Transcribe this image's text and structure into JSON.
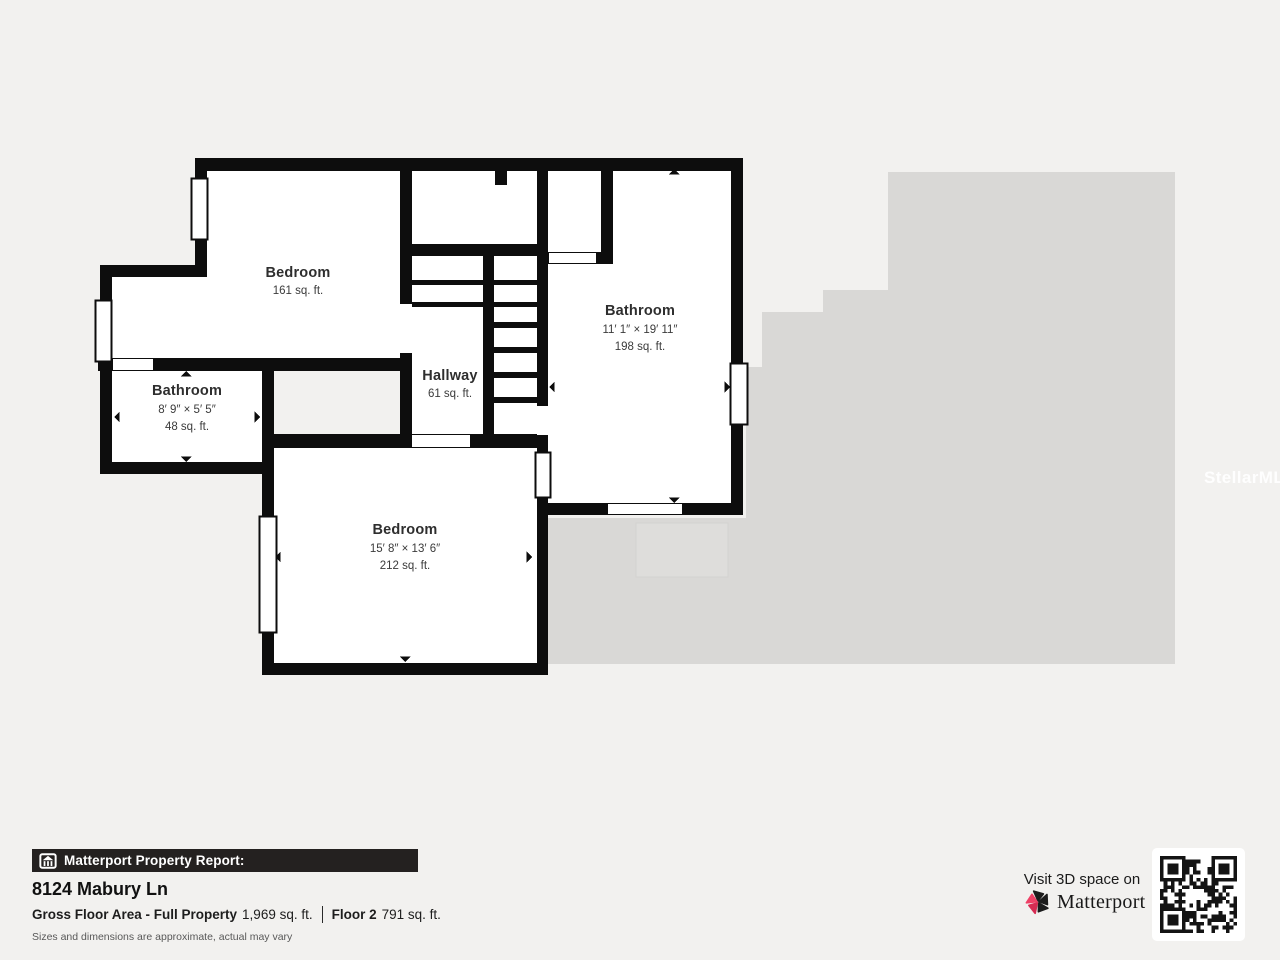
{
  "colors": {
    "background": "#f2f1ef",
    "silhouette_gray": "#d9d8d6",
    "wall_black": "#0d0d0d",
    "accent_pink": "#e93c5f",
    "report_bar_bg": "#242120"
  },
  "floor_plan": {
    "watermark": "StellarMLS",
    "rooms": [
      {
        "name": "Bedroom",
        "dims": "",
        "area": "161 sq. ft."
      },
      {
        "name": "Bathroom",
        "dims": "8′ 9″ × 5′ 5″",
        "area": "48 sq. ft."
      },
      {
        "name": "Hallway",
        "dims": "",
        "area": "61 sq. ft."
      },
      {
        "name": "Bathroom",
        "dims": "11′ 1″ × 19′ 11″",
        "area": "198 sq. ft."
      },
      {
        "name": "Bedroom",
        "dims": "15′ 8″ × 13′ 6″",
        "area": "212 sq. ft."
      }
    ]
  },
  "report": {
    "bar_title": "Matterport Property Report:",
    "address": "8124 Mabury Ln",
    "gross_area_label": "Gross Floor Area - Full Property",
    "gross_area_value": "1,969 sq. ft.",
    "floor_label": "Floor 2",
    "floor_value": "791 sq. ft.",
    "disclaimer": "Sizes and dimensions are approximate, actual may vary"
  },
  "promo": {
    "visit_text": "Visit 3D space on",
    "brand": "Matterport"
  }
}
